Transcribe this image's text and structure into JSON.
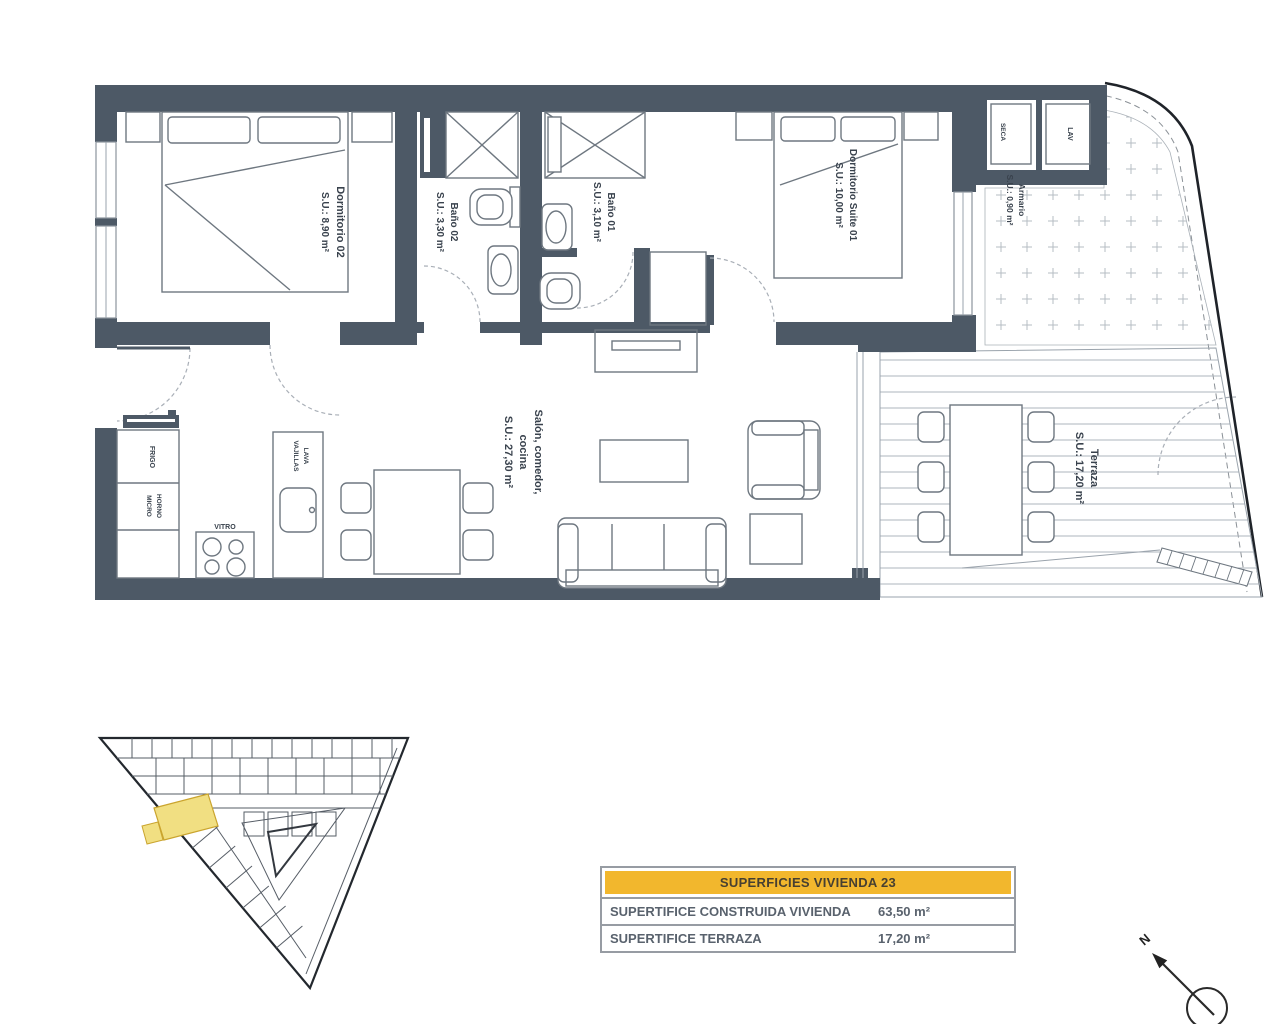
{
  "plan": {
    "rooms": {
      "dormitorio02": {
        "name": "Dormitorio 02",
        "area": "S.U.: 8,90 m²"
      },
      "bano02": {
        "name": "Baño 02",
        "area": "S.U.: 3,30 m²"
      },
      "bano01": {
        "name": "Baño 01",
        "area": "S.U.: 3,10 m²"
      },
      "suite01": {
        "name": "Dormitorio Suite 01",
        "area": "S.U.: 10,00 m²"
      },
      "armario": {
        "name": "Armario",
        "area": "S.U.: 0,90 m²"
      },
      "salon": {
        "line1": "Salón, comedor,",
        "line2": "cocina",
        "area": "S.U.: 27,30 m²"
      },
      "terraza": {
        "name": "Terraza",
        "area": "S.U.: 17,20 m²"
      }
    },
    "kitchen": {
      "frigo": "FRIGO",
      "horno": "HORNO",
      "micro": "MICRO",
      "vitro": "VITRO",
      "lava": "LAVA",
      "vajillas": "VAJILLAS"
    },
    "laundry": {
      "lav": "LAV",
      "seca": "SECA"
    }
  },
  "summary_table": {
    "header": "SUPERFICIES VIVIENDA 23",
    "rows": [
      {
        "label": "SUPERTIFICE CONSTRUIDA VIVIENDA",
        "value": "63,50 m²"
      },
      {
        "label": "SUPERTIFICE TERRAZA",
        "value": "17,20 m²"
      }
    ]
  },
  "compass": {
    "north_label": "N"
  },
  "colors": {
    "wall": "#4d5966",
    "accent_yellow": "#f2b72d",
    "highlight_yellow": "#f1df82"
  }
}
